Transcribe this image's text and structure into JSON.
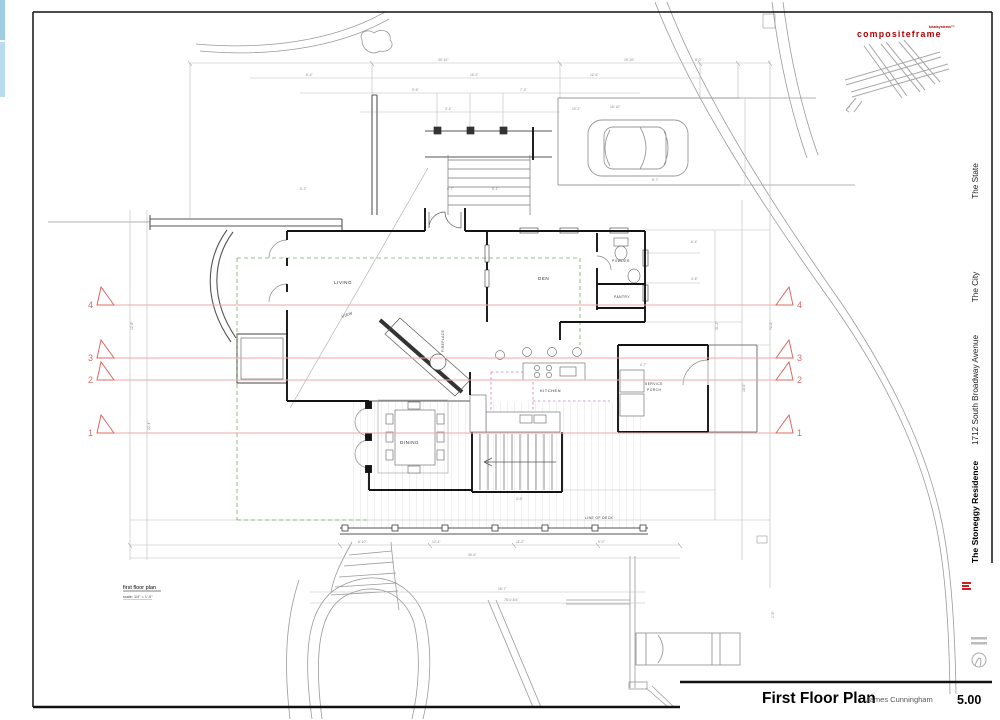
{
  "titleblock": {
    "plan_title": "First Floor Plan",
    "author": "James Cunningham",
    "sheet_number": "5.00",
    "brand": "compositeframe",
    "brand_sub": "totalsystems™",
    "address": "1712 South Broadway Avenue",
    "city": "The City",
    "state": "The State",
    "residence": "The Stoneggy Residence"
  },
  "plan_note": {
    "label": "first floor plan",
    "scale": "scale: 1/4\" = 1'-0\""
  },
  "colors": {
    "section_line": "#ecaaa8",
    "section_marker": "#dc6a64",
    "green_dash": "#55a245",
    "magenta_dash": "#c46ec4",
    "wall": "#141414",
    "site_gray": "#9a9a9a",
    "dim_gray": "#b9b9b9",
    "brand_red": "#b00000",
    "blue_strip": "#aed7ea"
  },
  "rooms": [
    {
      "label": "LIVING",
      "x": 334,
      "y": 284,
      "s": 4.6
    },
    {
      "label": "VIEW",
      "x": 342,
      "y": 318,
      "s": 3.8,
      "r": -20
    },
    {
      "label": "DEN",
      "x": 538,
      "y": 280,
      "s": 4.6
    },
    {
      "label": "POWDER",
      "x": 612,
      "y": 262,
      "s": 3.3
    },
    {
      "label": "PANTRY",
      "x": 614,
      "y": 298,
      "s": 3.3
    },
    {
      "label": "KITCHEN",
      "x": 540,
      "y": 392,
      "s": 4
    },
    {
      "label": "SERVICE",
      "x": 645,
      "y": 385,
      "s": 3.3
    },
    {
      "label": "PORCH",
      "x": 647,
      "y": 391,
      "s": 3.3
    },
    {
      "label": "DINING",
      "x": 400,
      "y": 444,
      "s": 4.6
    },
    {
      "label": "FIREPLACE",
      "x": 444,
      "y": 352,
      "s": 3.2,
      "r": -90
    },
    {
      "label": "LINE OF DECK",
      "x": 585,
      "y": 519,
      "s": 3.2
    }
  ],
  "sections": {
    "x1": 104,
    "x2": 780,
    "markers": [
      {
        "n": "4",
        "y": 305
      },
      {
        "n": "3",
        "y": 358
      },
      {
        "n": "2",
        "y": 380
      },
      {
        "n": "1",
        "y": 433
      }
    ]
  },
  "dims": [
    {
      "t": "30'-10\"",
      "x": 438,
      "y": 61
    },
    {
      "t": "19'-10\"",
      "x": 624,
      "y": 61
    },
    {
      "t": "8'-0\"",
      "x": 695,
      "y": 61
    },
    {
      "t": "8'-4\"",
      "x": 306,
      "y": 76
    },
    {
      "t": "16'-2\"",
      "x": 470,
      "y": 76
    },
    {
      "t": "12'-6\"",
      "x": 590,
      "y": 76
    },
    {
      "t": "9'-6\"",
      "x": 412,
      "y": 91
    },
    {
      "t": "7'-3\"",
      "x": 520,
      "y": 91
    },
    {
      "t": "3'-4\"",
      "x": 445,
      "y": 110
    },
    {
      "t": "10'-2\"",
      "x": 572,
      "y": 110
    },
    {
      "t": "16'-10\"",
      "x": 610,
      "y": 108
    },
    {
      "t": "6'-7\"",
      "x": 447,
      "y": 190
    },
    {
      "t": "8'-1\"",
      "x": 492,
      "y": 190
    },
    {
      "t": "5'-2\"",
      "x": 300,
      "y": 190
    },
    {
      "t": "6'-4\"",
      "x": 691,
      "y": 243
    },
    {
      "t": "3'-6\"",
      "x": 691,
      "y": 280
    },
    {
      "t": "4'-7\"",
      "x": 640,
      "y": 366
    },
    {
      "t": "31'-2\"",
      "x": 718,
      "y": 330,
      "r": -90
    },
    {
      "t": "18'-6\"",
      "x": 745,
      "y": 392,
      "r": -90
    },
    {
      "t": "72'-8\"",
      "x": 772,
      "y": 330,
      "r": -90
    },
    {
      "t": "12'-8\"",
      "x": 133,
      "y": 330,
      "r": -90
    },
    {
      "t": "22'-4\"",
      "x": 150,
      "y": 430,
      "r": -90
    },
    {
      "t": "6'-10\"",
      "x": 358,
      "y": 543
    },
    {
      "t": "12'-4\"",
      "x": 432,
      "y": 543
    },
    {
      "t": "11'-2\"",
      "x": 516,
      "y": 543
    },
    {
      "t": "9'-0\"",
      "x": 598,
      "y": 543
    },
    {
      "t": "30'-6\"",
      "x": 468,
      "y": 556
    },
    {
      "t": "16'-7\"",
      "x": 498,
      "y": 590
    },
    {
      "t": "78'-0 3/4\"",
      "x": 504,
      "y": 601
    },
    {
      "t": "8'-7\"",
      "x": 652,
      "y": 181
    },
    {
      "t": "3'-6\"",
      "x": 516,
      "y": 500
    },
    {
      "t": "1'-6\"",
      "x": 774,
      "y": 618,
      "r": -90
    }
  ]
}
